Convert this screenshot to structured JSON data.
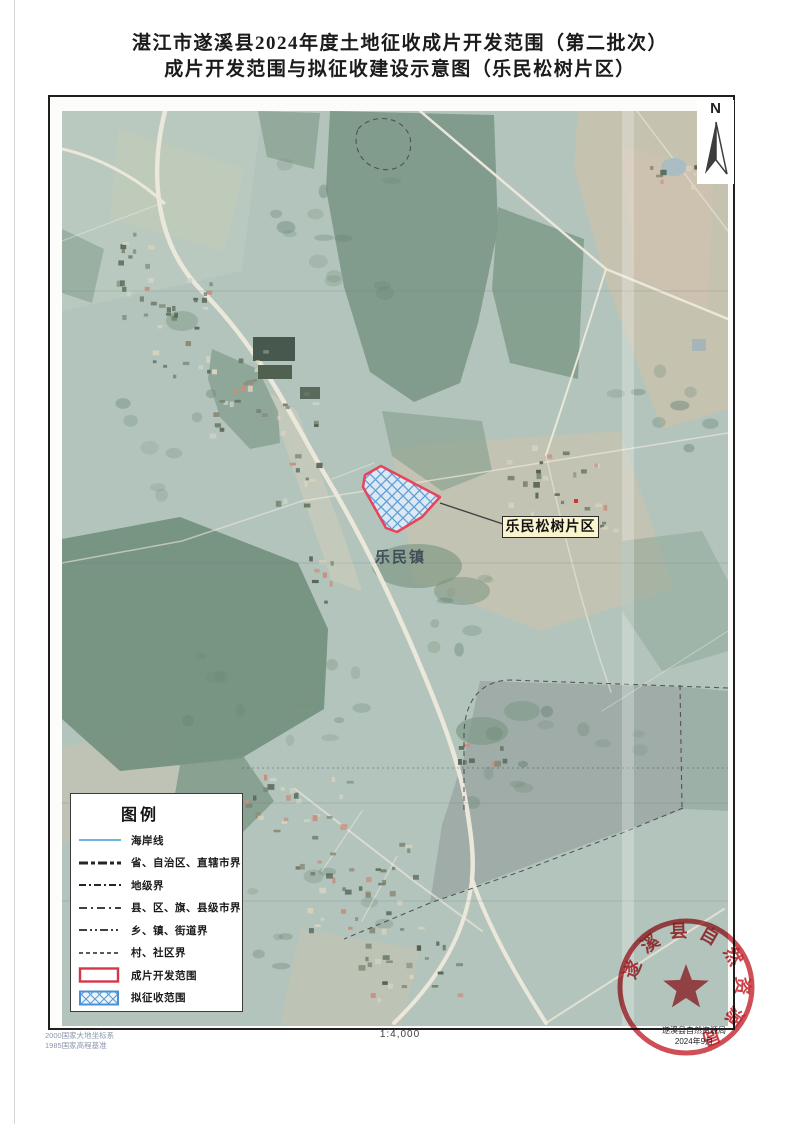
{
  "doc": {
    "title_line1": "湛江市遂溪县2024年度土地征收成片开发范围（第二批次）",
    "title_line2": "成片开发范围与拟征收建设示意图（乐民松树片区）"
  },
  "map": {
    "north_label": "N",
    "parcel_label": "乐民松树片区",
    "town_label": "乐民镇"
  },
  "legend": {
    "title": "图例",
    "items": [
      {
        "label": "海岸线"
      },
      {
        "label": "省、自治区、直辖市界"
      },
      {
        "label": "地级界"
      },
      {
        "label": "县、区、旗、县级市界"
      },
      {
        "label": "乡、镇、街道界"
      },
      {
        "label": "村、社区界"
      },
      {
        "label": "成片开发范围"
      },
      {
        "label": "拟征收范围"
      }
    ]
  },
  "footer": {
    "datum_line1": "2000国家大地坐标系",
    "datum_line2": "1985国家高程基准",
    "scale_text": "1:4,000",
    "agency": "遂溪县自然资源局",
    "date": "2024年9月"
  },
  "seal": {
    "text": "遂溪县自然资源局"
  },
  "colors": {
    "development_outline": "#e8435a",
    "expropriation_hatch": "#5b9bd5",
    "coastline": "#6db6e3",
    "seal_red": "#c2232b",
    "label_bg": "#fbf5cf"
  }
}
